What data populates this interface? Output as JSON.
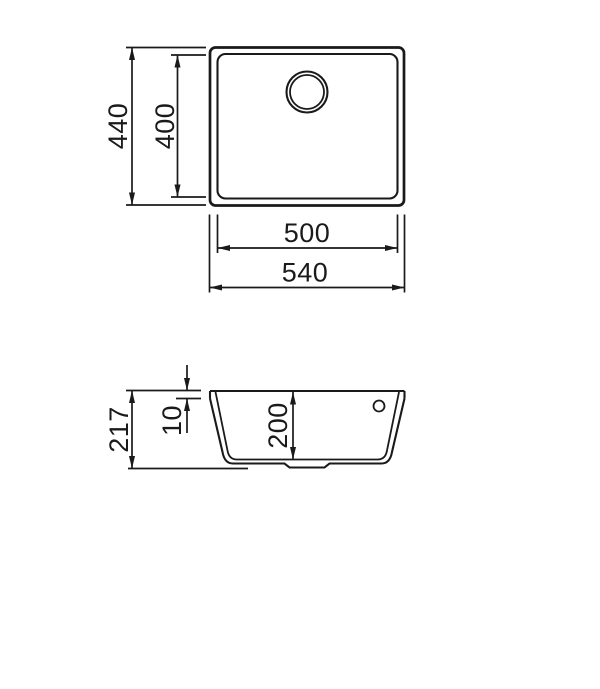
{
  "page": {
    "background": "#ffffff",
    "ink": "#1a1a1a",
    "subject": "sink technical drawing"
  },
  "top_view": {
    "outer_height": "440",
    "inner_height": "400",
    "inner_width": "500",
    "outer_width": "540"
  },
  "section_view": {
    "total_height": "217",
    "rim_height": "10",
    "bowl_depth": "200"
  }
}
